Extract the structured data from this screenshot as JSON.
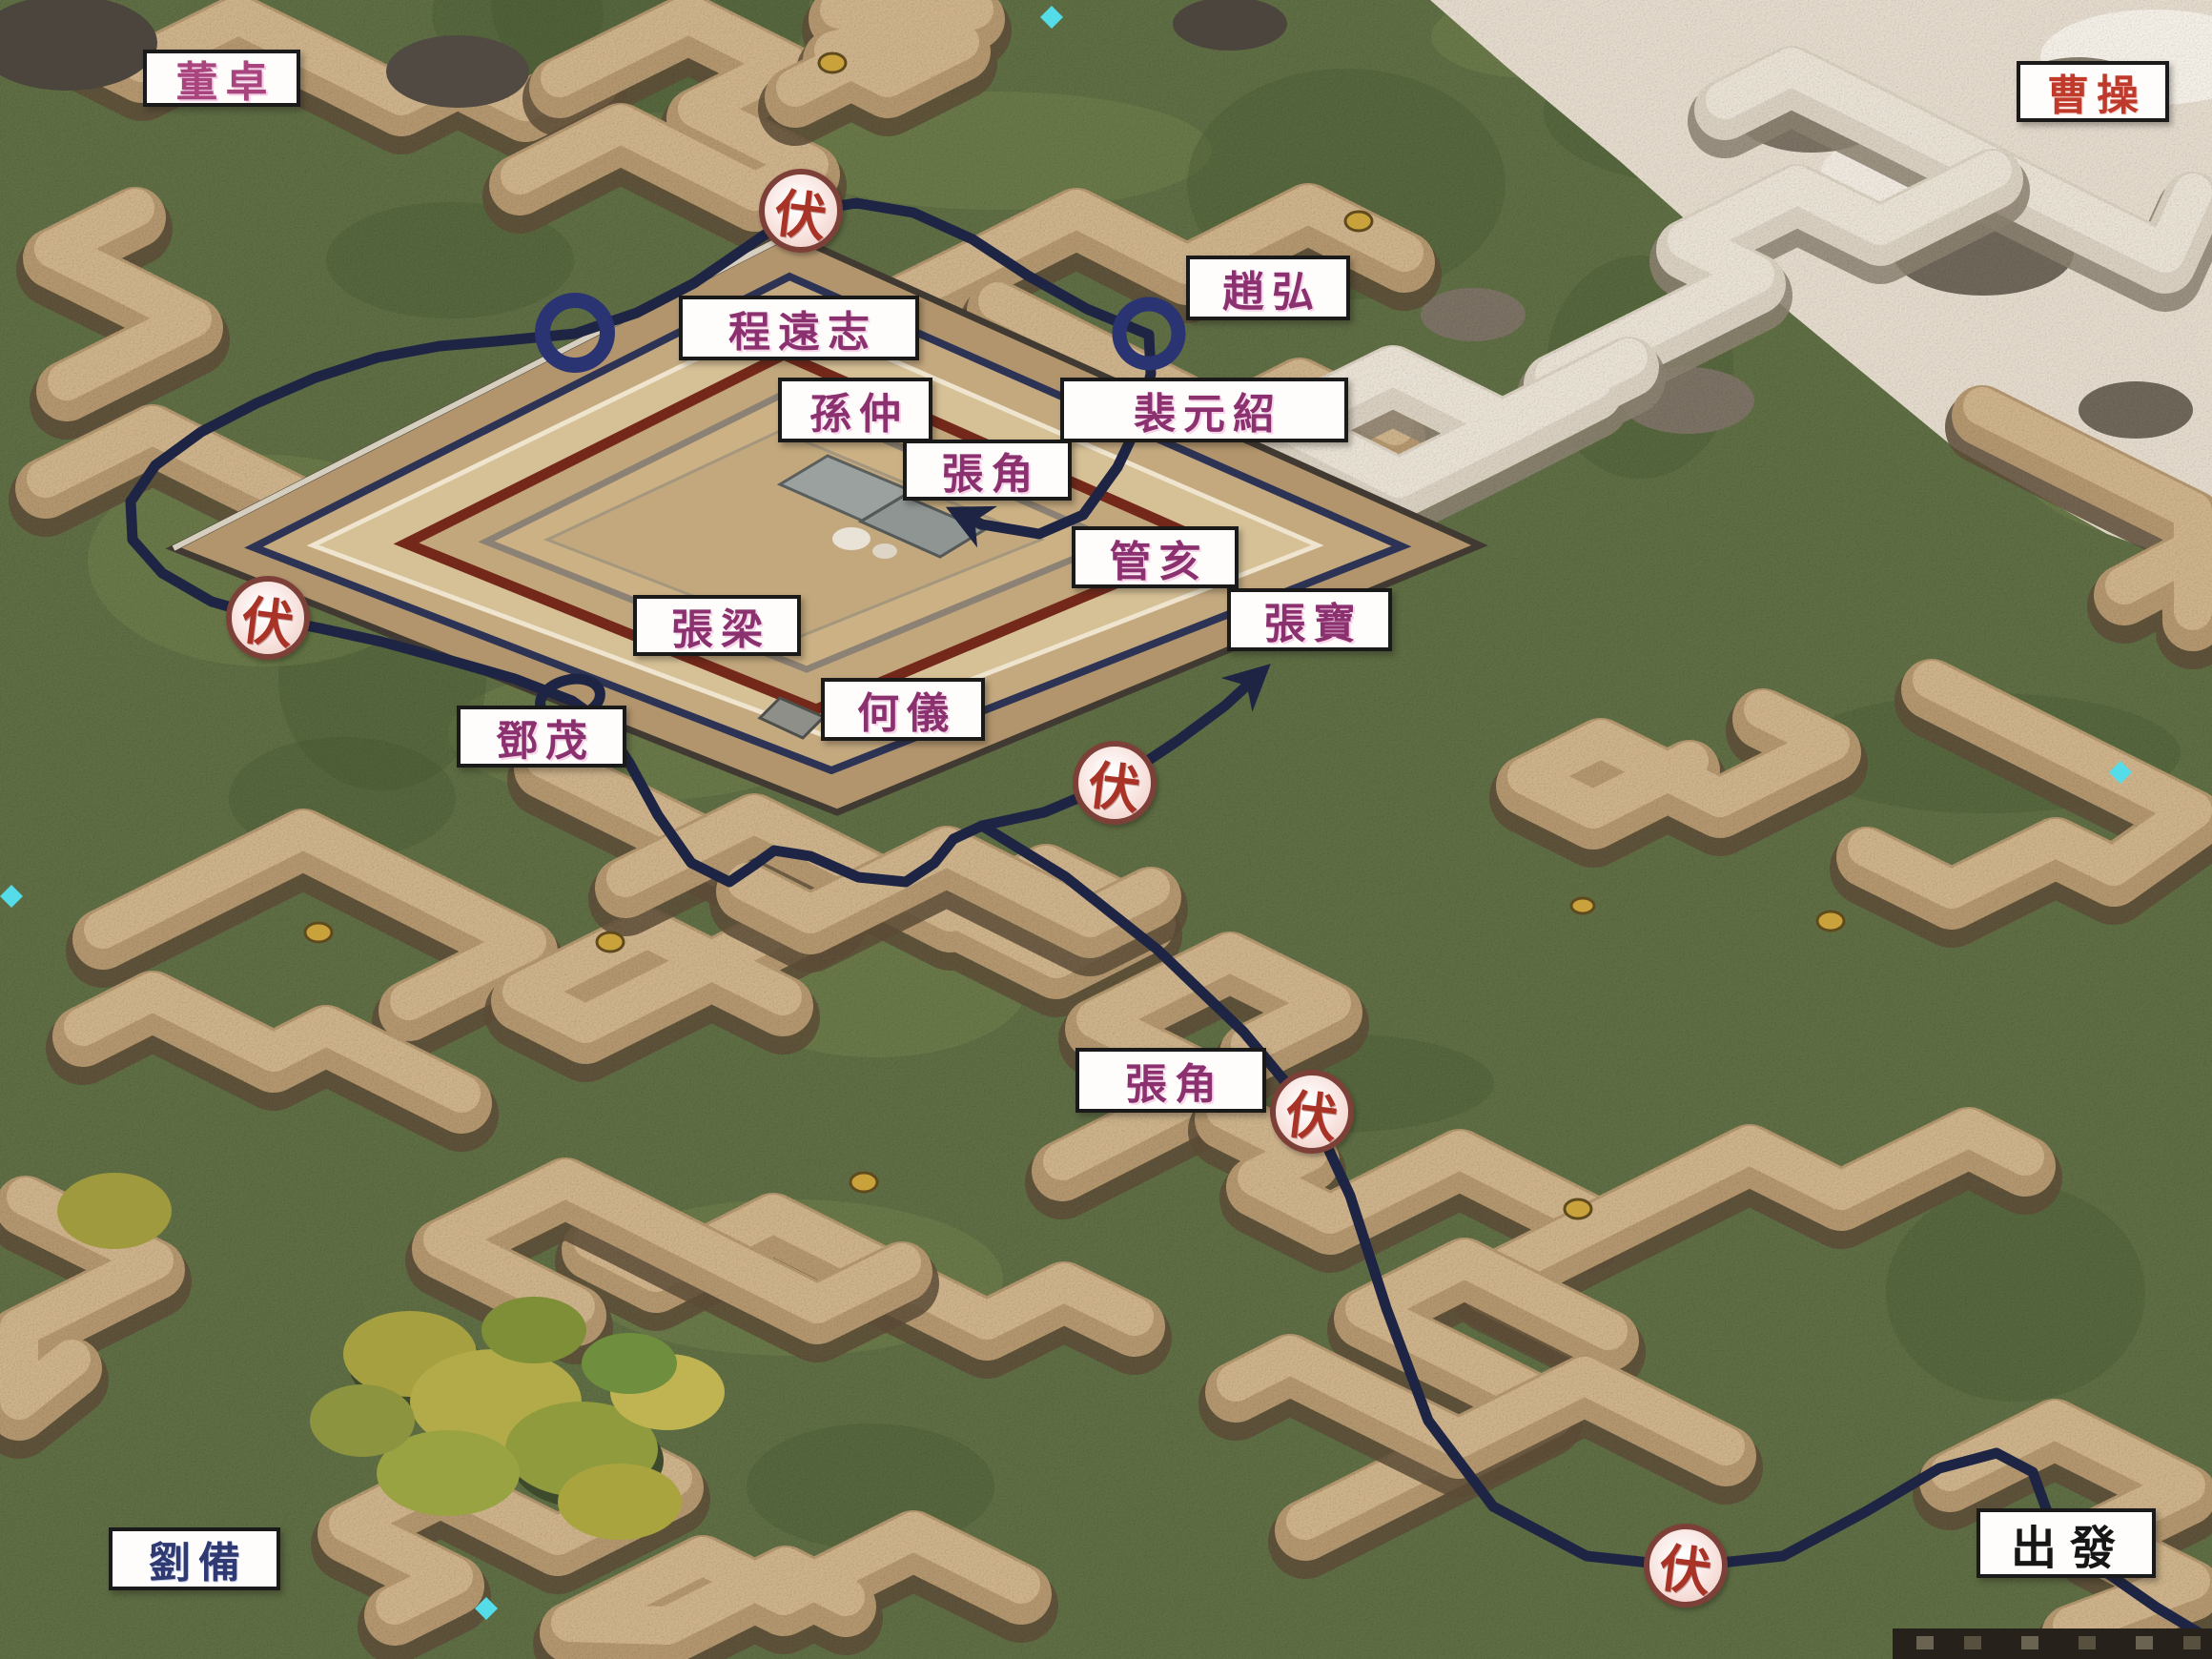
{
  "factions": {
    "dong_zhuo": "董卓",
    "cao_cao": "曹操",
    "liu_bei": "劉備"
  },
  "route": {
    "start_label": "出發",
    "ambush_label": "伏",
    "ambush_count": 5
  },
  "officers": {
    "cheng_yuanzhi": "程遠志",
    "zhao_hong": "趙弘",
    "sun_zhong": "孫仲",
    "pei_yuanshao": "裴元紹",
    "zhang_jiao_fortress": "張角",
    "guan_hai": "管亥",
    "zhang_liang": "張梁",
    "zhang_bao": "張寶",
    "he_yi": "何儀",
    "deng_mao": "鄧茂",
    "zhang_jiao_route": "張角"
  },
  "colors": {
    "route_line": "#1e2544",
    "route_ring": "#2b3472",
    "ambush_text": "#a93327",
    "officer_text": "#8c3170",
    "cao_cao_text": "#c03a2c",
    "liu_bei_text": "#2f3a73",
    "start_text": "#161616",
    "grass": "#5f6e44",
    "ridge": "#b4976f",
    "fort_wall_red": "#74281a",
    "pale_corner": "#e4dbcd"
  }
}
